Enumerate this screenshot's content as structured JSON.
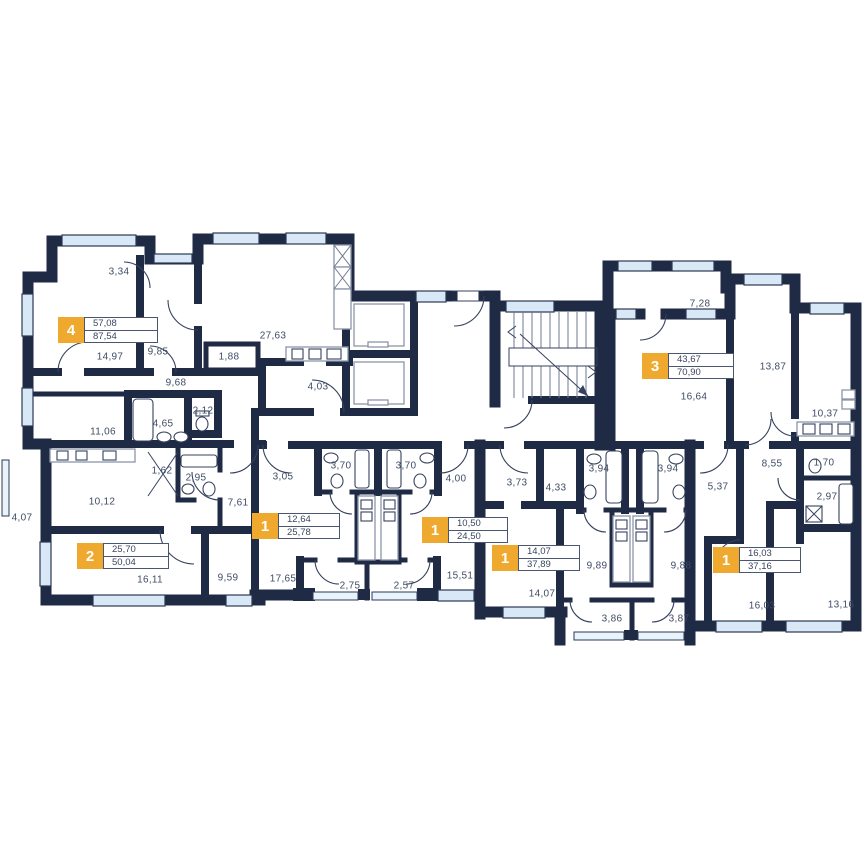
{
  "plan_title": "Residential floor plan",
  "colors": {
    "wall": "#1f2a44",
    "window": "#d8e8f7",
    "badge": "#efa92e",
    "text": "#3f4c66"
  },
  "apartments": [
    {
      "number": "4",
      "living_area": "57,08",
      "total_area": "87,54"
    },
    {
      "number": "3",
      "living_area": "43,67",
      "total_area": "70,90"
    },
    {
      "number": "2",
      "living_area": "25,70",
      "total_area": "50,04"
    },
    {
      "number": "1",
      "living_area": "12,64",
      "total_area": "25,78"
    },
    {
      "number": "1",
      "living_area": "10,50",
      "total_area": "24,50"
    },
    {
      "number": "1",
      "living_area": "14,07",
      "total_area": "37,89"
    },
    {
      "number": "1",
      "living_area": "16,03",
      "total_area": "37,16"
    }
  ],
  "rooms": [
    {
      "area": "3,34"
    },
    {
      "area": "14,97"
    },
    {
      "area": "9,85"
    },
    {
      "area": "27,63"
    },
    {
      "area": "1,88"
    },
    {
      "area": "9,68"
    },
    {
      "area": "4,03"
    },
    {
      "area": "4,65"
    },
    {
      "area": "2,12"
    },
    {
      "area": "11,06"
    },
    {
      "area": "1,62"
    },
    {
      "area": "2,95"
    },
    {
      "area": "10,12"
    },
    {
      "area": "7,61"
    },
    {
      "area": "4,07"
    },
    {
      "area": "16,11"
    },
    {
      "area": "9,59"
    },
    {
      "area": "3,05"
    },
    {
      "area": "3,70"
    },
    {
      "area": "3,70"
    },
    {
      "area": "4,00"
    },
    {
      "area": "17,65"
    },
    {
      "area": "2,75"
    },
    {
      "area": "2,57"
    },
    {
      "area": "15,51"
    },
    {
      "area": "3,73"
    },
    {
      "area": "4,33"
    },
    {
      "area": "3,94"
    },
    {
      "area": "3,94"
    },
    {
      "area": "9,89"
    },
    {
      "area": "9,88"
    },
    {
      "area": "14,07"
    },
    {
      "area": "3,86"
    },
    {
      "area": "3,87"
    },
    {
      "area": "5,37"
    },
    {
      "area": "8,55"
    },
    {
      "area": "1,70"
    },
    {
      "area": "2,97"
    },
    {
      "area": "16,03"
    },
    {
      "area": "13,16"
    },
    {
      "area": "7,28"
    },
    {
      "area": "16,64"
    },
    {
      "area": "13,87"
    },
    {
      "area": "10,37"
    }
  ]
}
